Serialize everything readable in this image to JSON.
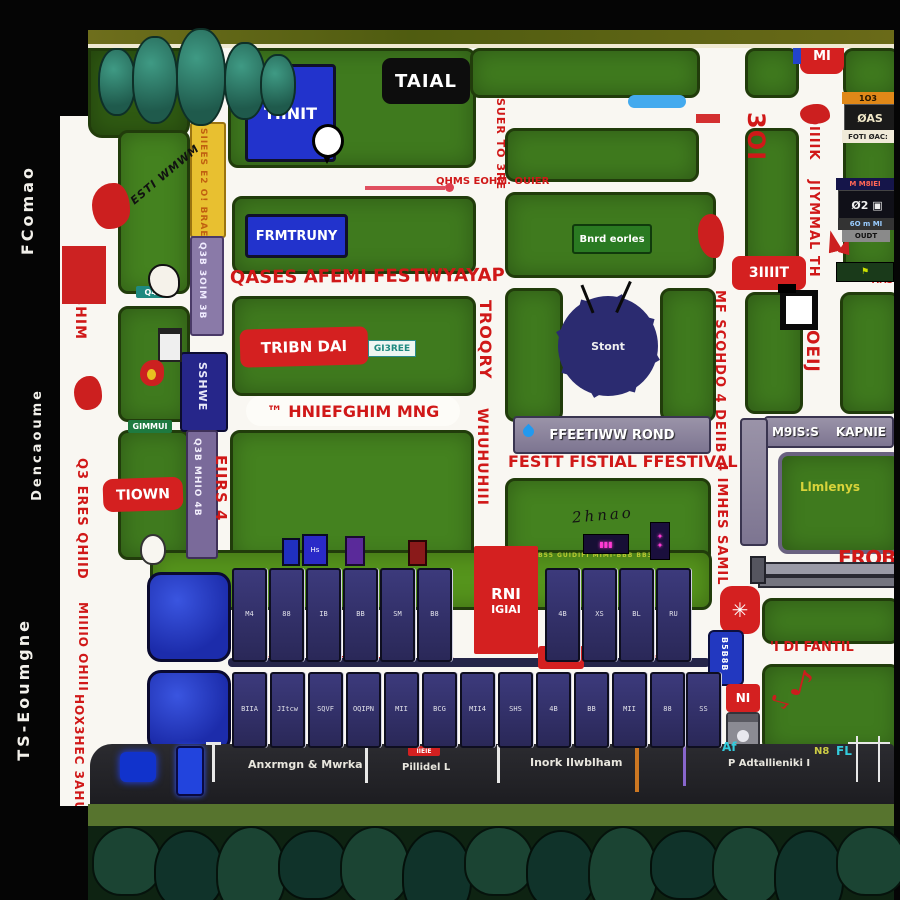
{
  "colors": {
    "accent_red": "#d42020",
    "map_green": "#3f7a1e",
    "booth_navy": "#32306e",
    "sign_blue": "#2233cc"
  },
  "sidebar": {
    "text_top": "FComao",
    "text_mid": "Dencaoume",
    "text_bottom": "TS-Eoumgne"
  },
  "top": {
    "tinit": "TIINIT",
    "taial": "TAIAL",
    "mi_badge": "MI",
    "road_label": "QHMS EOHM. OUIER",
    "suer_vertical": "SUER TO 3RE",
    "e301": "3OI",
    "omik": "OIIIIK",
    "jiymmal": "JIYMMAL TH"
  },
  "strips": {
    "yellow": "SIIEES E2 O! BRAEJ",
    "purple_a": "Q3B 3OIM 3B",
    "sshwe": "SSHWE",
    "purple_b": "Q3B MHIO 4B",
    "eiirs": "EIIRS 4"
  },
  "left_road": {
    "t1": "XIIII BHIM",
    "t2": "Q3 ERES QHIID",
    "t3": "MIIIIO OHIII",
    "t4": "HOX3HEC 3AHUGIOY"
  },
  "blocks": {
    "diag_label": "ESTI WMWM",
    "q4_sign": "Q4?",
    "gimmui_sign": "GIMMUI",
    "frmtruny": "FRMTRUNY",
    "bnrd": "Bnrd eorles",
    "gi3ree": "GI3REE",
    "limlenys": "Llmlenys",
    "cursive": "2hnao",
    "dots_text": "B55 GUIDIFI MIMI-BBB BB3"
  },
  "labels": {
    "qases": "QASES AFEMI FESTWYAYAP",
    "tribn": "TRIBN DAI",
    "hnief": "™ HNIEFGHIM MNG",
    "tiown": "TIOWN",
    "festt": "FESTT FISTIAL FFESTIVAL",
    "pond": "FFEETIWW ROND",
    "m9iss": "M9IS:S",
    "kapnie": "KAPNIE",
    "siiit": "3IIIIT",
    "oeij": "OEIJ",
    "troqry": "TROQRY",
    "whuhu": "WHUHUHIII",
    "mfsco": "MF SCOHDO 4 DEIIB",
    "imhes": "4 IMHES SAMIL",
    "erobrs": "EROBRS",
    "difantil": "'I DI FANTIL",
    "zaik": "ZAIK",
    "qbiei": "QBIEI",
    "bswine": "B&S WINE CUBOS",
    "mm": "MM?",
    "bm": "BM?",
    "ni": "NI",
    "b5b8b": "B5B8B",
    "rni_top": "RNI",
    "rni_bottom": "IGIAI",
    "tias": "TIAS",
    "hs_booth": "Hs"
  },
  "sun": {
    "label": "Stont"
  },
  "clusters": {
    "c1": [
      "1O3",
      "ØAS",
      "FOTI ØAC:"
    ],
    "c2": [
      "M M8IEI",
      "Ø2 ▣",
      "6O m MI",
      "OUDT"
    ]
  },
  "bottom_road": {
    "l1": "Anxrmgn & Mwrka",
    "l2": "Pillidel L",
    "l3": "Inork Ilwblham",
    "l4": "P Adtallieniki I",
    "badge": "IIEIE",
    "icon1": "Af",
    "icon2": "N8",
    "icon3": "FL"
  },
  "booths": {
    "row1": {
      "labels": [
        "M4",
        "88",
        "IB",
        "BB",
        "SM",
        "B8",
        "4B",
        "XS",
        "BL",
        "RU"
      ]
    },
    "row2": {
      "labels": [
        "BIIA",
        "JItcw",
        "SQVF",
        "OQIPN",
        "MII",
        "BCG",
        "MII4",
        "SHS",
        "4B",
        "BB",
        "MII",
        "88",
        "SS"
      ]
    }
  }
}
